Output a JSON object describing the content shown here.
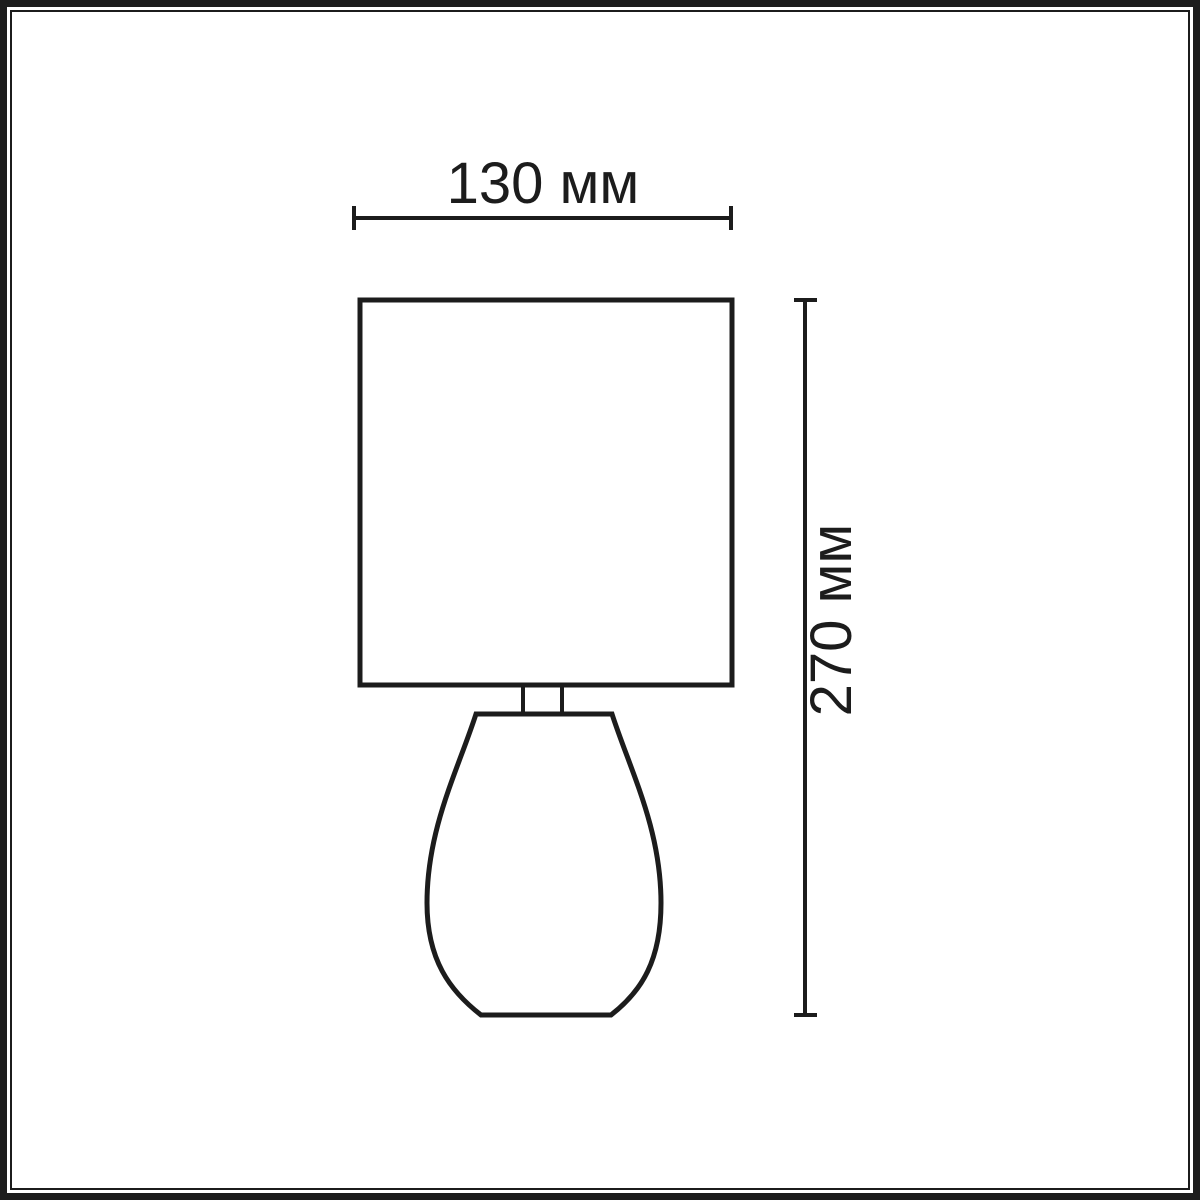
{
  "frame": {
    "border_color": "#1c1c1c",
    "background_color": "#ffffff"
  },
  "diagram": {
    "stroke_color": "#1c1c1c",
    "dimensions": {
      "width": {
        "label": "130 мм",
        "value_mm": 130
      },
      "height": {
        "label": "270 мм",
        "value_mm": 270
      }
    }
  }
}
